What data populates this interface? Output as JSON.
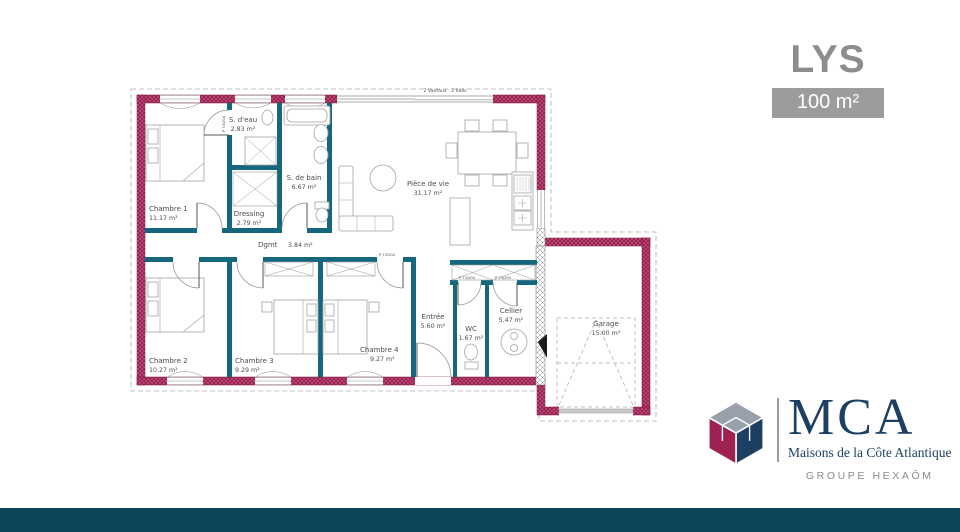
{
  "header": {
    "title": "LYS",
    "area_badge": "100 m²"
  },
  "brand": {
    "name": "MCA",
    "tagline": "Maisons de la Côte Atlantique",
    "group": "GROUPE HEXAÔM"
  },
  "rooms": [
    {
      "name": "Chambre 1",
      "area": "11.17 m²"
    },
    {
      "name": "S. d'eau",
      "area": "2.83 m²"
    },
    {
      "name": "S. de bain",
      "area": "6.67 m²"
    },
    {
      "name": "Dressing",
      "area": "2.79 m²"
    },
    {
      "name": "Dgmt",
      "area": "3.84 m²"
    },
    {
      "name": "Pièce de vie",
      "area": "31.17 m²"
    },
    {
      "name": "Chambre 2",
      "area": "10.27 m²"
    },
    {
      "name": "Chambre 3",
      "area": "9.29 m²"
    },
    {
      "name": "Chambre 4",
      "area": "9.27 m²"
    },
    {
      "name": "Entrée",
      "area": "5.60 m²"
    },
    {
      "name": "WC",
      "area": "1.67 m²"
    },
    {
      "name": "Cellier",
      "area": "5.47 m²"
    },
    {
      "name": "Garage",
      "area": "15.00 m²"
    }
  ],
  "plan": {
    "bay_label": "2 Vantaux - 2 Rails",
    "door_label": "P 73/204"
  },
  "colors": {
    "exterior_wall": "#9e2152",
    "interior_wall": "#15677e",
    "footer_bar": "#0c4557",
    "title_gray": "#8d8d8d",
    "badge_bg": "#9c9c9c",
    "brand_navy": "#1d3f63"
  }
}
